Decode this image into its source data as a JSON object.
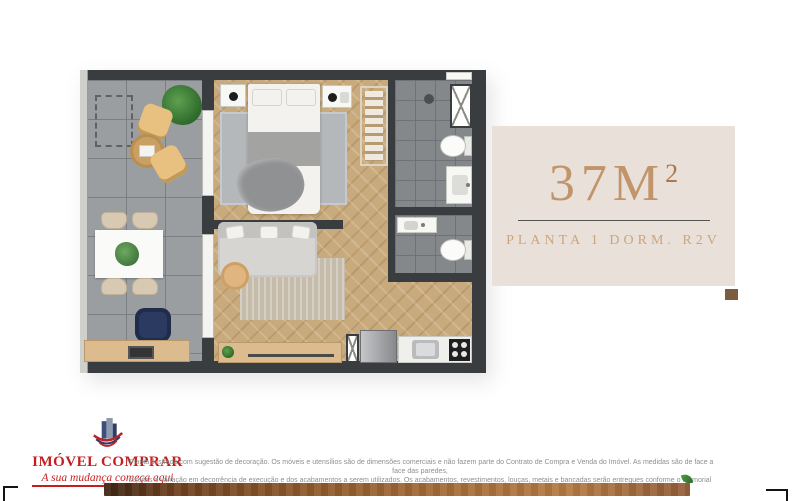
{
  "page": {
    "background": "#ffffff"
  },
  "info_panel": {
    "area_value": "37M",
    "area_superscript": "2",
    "subtitle": "PLANTA 1 DORM. R2V",
    "panel_bg": "#e8e0d9",
    "accent_color": "#c2946a",
    "square_color": "#7d5b3e"
  },
  "logo": {
    "brand": "IMÓVEL COMPRAR",
    "tagline": "A sua mudança começa aqui",
    "brand_color": "#c41e20",
    "icon": "building-swoosh-icon"
  },
  "disclaimer": {
    "line1": "*Planta ilustrada com sugestão de decoração. Os móveis e utensílios são de dimensões comerciais e não fazem parte do Contrato de Compra e Venda do Imóvel. As medidas são de face a face das paredes,",
    "line2": "sujeitas a variação em decorrência de execução e dos acabamentos a serem utilizados. Os acabamentos, revestimentos, louças, metais e bancadas serão entregues conforme o Memorial Descritivo."
  },
  "floorplan": {
    "wall_color": "#3a3d40",
    "wood_floor_color": "#c9aa7c",
    "balcony_floor_color": "#9b9ea1",
    "bathroom_floor_color": "#84888b",
    "elements": [
      "balcony-terrace",
      "ac-unit-outline",
      "lounge-chairs",
      "round-coffee-table",
      "plant",
      "dining-table",
      "dining-chairs",
      "desk",
      "office-chair",
      "laptop",
      "glass-sliding-doors",
      "bed",
      "pillows",
      "nightstands",
      "bedroom-rug",
      "wardrobe",
      "shower",
      "shower-glass",
      "toilet",
      "bathroom-sink",
      "lavabo-sink",
      "lavabo-toilet",
      "sofa",
      "side-table",
      "living-rug",
      "sideboard",
      "refrigerator",
      "kitchen-counter",
      "kitchen-sink",
      "cooktop",
      "service-shaft",
      "window"
    ]
  },
  "decor": {
    "wood_bar_colors": [
      "#3f2512",
      "#b57b45"
    ],
    "corner_bracket_color": "#141414",
    "sprout_color": "#2f6b2c"
  }
}
